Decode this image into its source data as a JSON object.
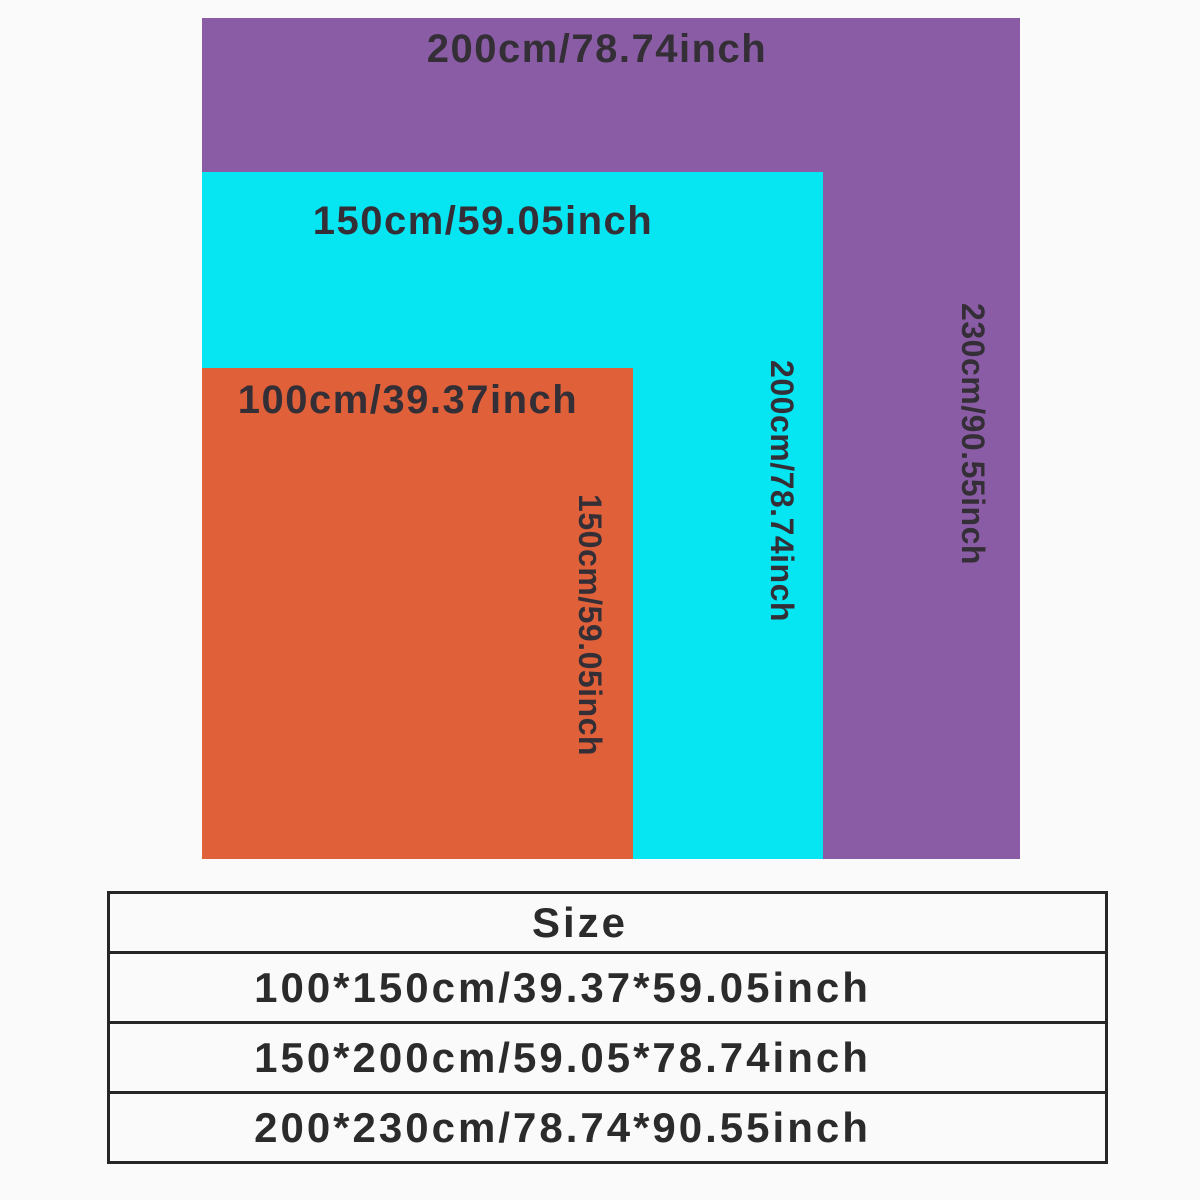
{
  "page": {
    "background": "#fbfafa",
    "label_text_color": "#342f36",
    "table_line_color": "#262626"
  },
  "diagram": {
    "rectangles": [
      {
        "name": "size-200x230",
        "color": "#8b5ca6",
        "width_label": "200cm/78.74inch",
        "height_label": "230cm/90.55inch"
      },
      {
        "name": "size-150x200",
        "color": "#06e5f2",
        "width_label": "150cm/59.05inch",
        "height_label": "200cm/78.74inch"
      },
      {
        "name": "size-100x150",
        "color": "#df6039",
        "width_label": "100cm/39.37inch",
        "height_label": "150cm/59.05inch"
      }
    ]
  },
  "size_table": {
    "header": "Size",
    "rows": [
      "100*150cm/39.37*59.05inch",
      "150*200cm/59.05*78.74inch",
      "200*230cm/78.74*90.55inch"
    ]
  }
}
